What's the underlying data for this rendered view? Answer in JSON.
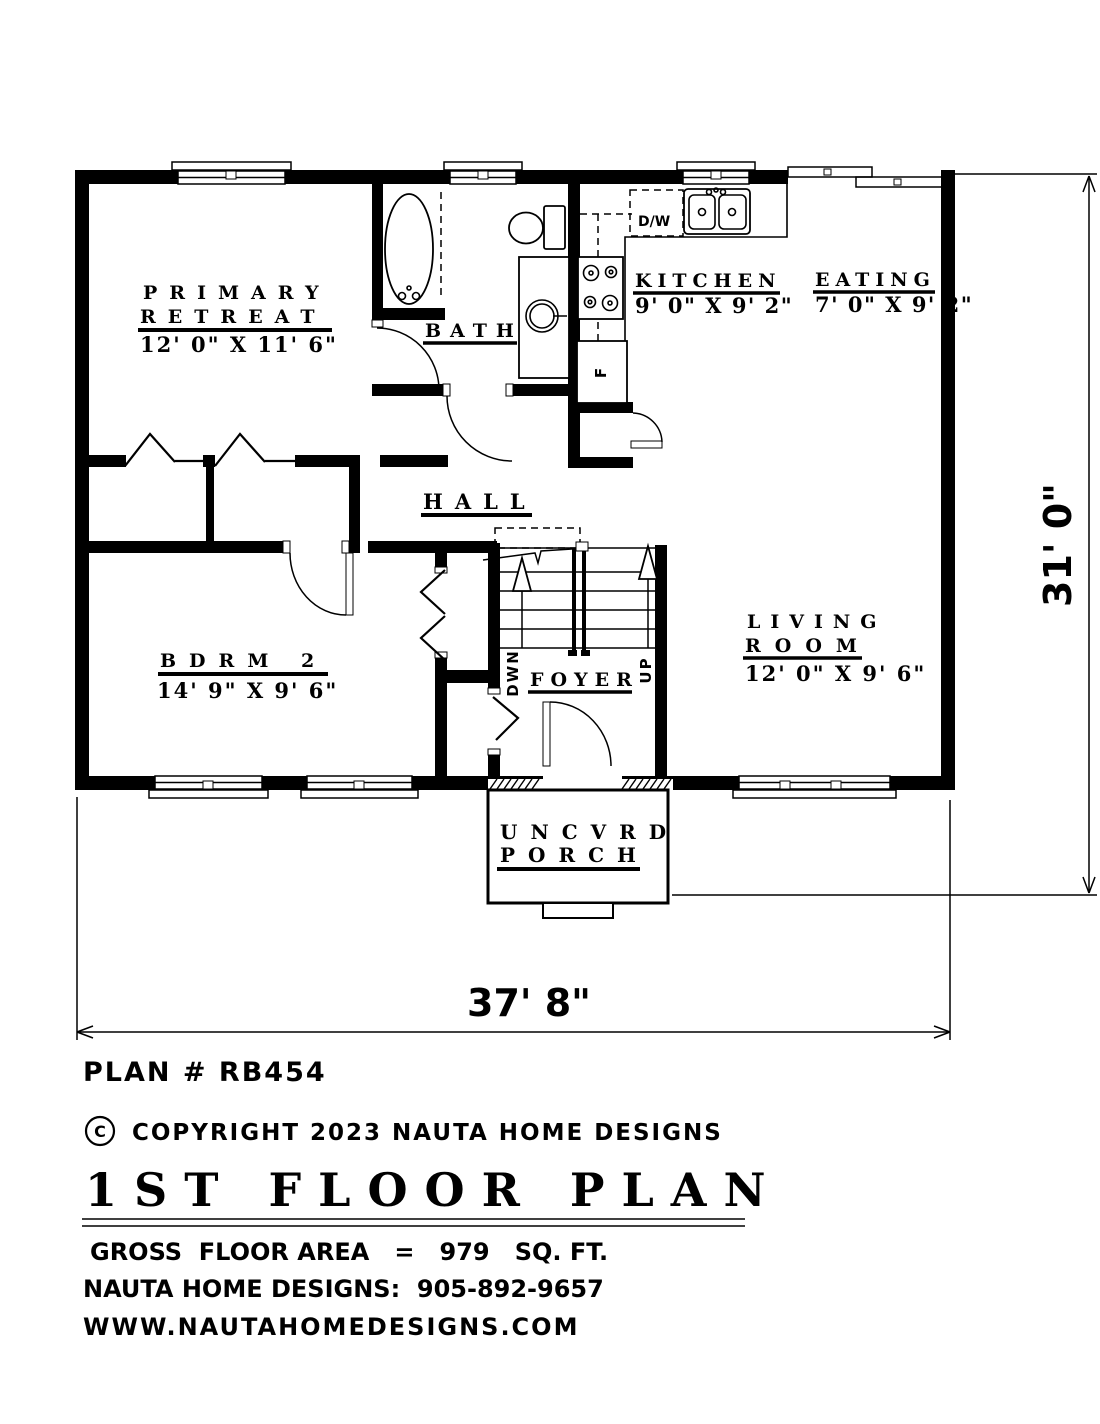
{
  "page": {
    "background": "#ffffff",
    "ink": "#000000"
  },
  "plan": {
    "rooms": {
      "primary": {
        "name1": "PRIMARY",
        "name2": "RETREAT",
        "dims": "12' 0\" X 11' 6\""
      },
      "bath": {
        "name": "BATH"
      },
      "kitchen": {
        "name": "KITCHEN",
        "dims": "9' 0\" X 9' 2\""
      },
      "eating": {
        "name": "EATING",
        "dims": "7' 0\" X 9' 2\""
      },
      "hall": {
        "name": "HALL"
      },
      "bdrm2": {
        "name": "BDRM 2",
        "dims": "14' 9\" X 9' 6\""
      },
      "living": {
        "name1": "LIVING",
        "name2": "ROOM",
        "dims": "12' 0\" X 9' 6\""
      },
      "foyer": {
        "name": "FOYER"
      },
      "porch": {
        "name1": "UNCVRD",
        "name2": "PORCH"
      }
    },
    "stairs": {
      "down_label": "DWN",
      "up_label": "UP"
    },
    "appliances": {
      "dishwasher": "D/W",
      "fridge": "F"
    },
    "dimensions": {
      "width": "37' 8\"",
      "height": "31' 0\""
    }
  },
  "title_block": {
    "plan_number": "PLAN # RB454",
    "copyright_symbol": "C",
    "copyright_text": "COPYRIGHT 2023 NAUTA HOME DESIGNS",
    "sheet_title": "1ST FLOOR PLAN",
    "gross_area": "GROSS  FLOOR AREA   =   979   SQ. FT.",
    "contact": "NAUTA HOME DESIGNS:  905-892-9657",
    "website": "WWW.NAUTAHOMEDESIGNS.COM"
  }
}
